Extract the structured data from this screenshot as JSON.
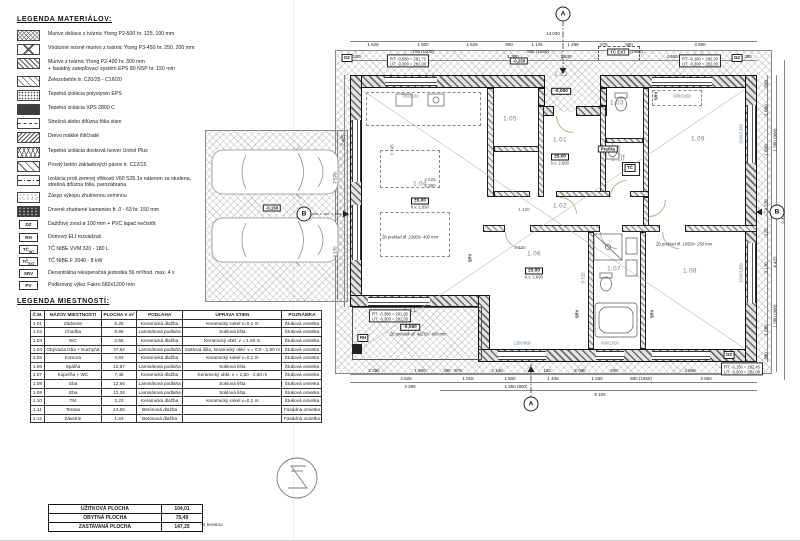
{
  "materials_legend": {
    "title": "LEGENDA MATERIÁLOV:",
    "items": [
      {
        "swatch": "hatch-cross",
        "text": "Murivo deliace z tvárnic Ytong P2-500 hr. 125, 100 mm"
      },
      {
        "swatch": "diag-cross",
        "text": "Vnútorné nosné murivo z tvárnic Ytong P3-450 hr. 250, 200 mm"
      },
      {
        "swatch": "hatch-diag",
        "text": "Murivo z tvárnic Ytong P2-400 hr. 300 mm\n+ fasádny zatepľovací systém EPS 80 NSP hr. 150 mm"
      },
      {
        "swatch": "diag-thin",
        "text": "Železobetón tr. C20/25 - C16/20"
      },
      {
        "swatch": "dots",
        "text": "Tepelná izolácia polystyrén EPS"
      },
      {
        "swatch": "solid-dark",
        "text": "Tepelná izolácia XPS 2800 C"
      },
      {
        "swatch": "dash-center",
        "text": "Strešná alebo difúzna fólia stien"
      },
      {
        "swatch": "back-diag",
        "text": "Drevo mäkké ihličnaté"
      },
      {
        "swatch": "zigzag",
        "text": "Tepelná izolácia dosková Isover Unirol Plus"
      },
      {
        "swatch": "diag-wide",
        "text": "Prostý betón základových pásov tr. C12/15"
      },
      {
        "swatch": "dashdot",
        "text": "Izolácia proti zemnej vlhkosti V60 S35 1x náterom za studena,\nstrešná difúzna fólia, parozábrana"
      },
      {
        "swatch": "stipple",
        "text": "Zásyp výkopu zhutnenou zeminou"
      },
      {
        "swatch": "gravel",
        "text": "Drvené zhutnené kamenivo fr. 0 - 63 hr. 150 mm"
      }
    ],
    "badges": [
      {
        "label": "DZ",
        "sub": "",
        "text": "Dažďový zvod ø 100 mm + PVC lapač nečistôt"
      },
      {
        "label": "RH",
        "sub": "",
        "text": "Domový ELI rozvádzač"
      },
      {
        "label": "TČ",
        "sub": "INT",
        "text": "TČ NIBE VVM 320 - 180 L"
      },
      {
        "label": "TČ",
        "sub": "EXT",
        "text": "TČ NIBE F 2040 - 8 kW"
      },
      {
        "label": "SRV",
        "sub": "",
        "text": "Decentrálna rekuperačná jednotka 56 m³/hod. max. 4 x"
      },
      {
        "label": "PV",
        "sub": "",
        "text": "Podkrovný výlez Fakro 660x1200 mm"
      }
    ]
  },
  "rooms_legend": {
    "title": "LEGENDA MIESTNOSTÍ:",
    "headers": [
      "Č.M.",
      "NÁZOV MIESTNOSTI",
      "PLOCHA V m²",
      "PODLAHA",
      "ÚPRAVA STIEN",
      "POZNÁMKA"
    ],
    "rows": [
      [
        "1.01",
        "Zádverie",
        "6,26",
        "Keramická dlažba",
        "Keramický sokel v=0,1 m",
        "Štuková omietka"
      ],
      [
        "1.02",
        "Chodba",
        "8,99",
        "Laminátová podlaha",
        "Soklová lišta",
        "Štuková omietka"
      ],
      [
        "1.03",
        "WC",
        "2,66",
        "Keramická dlažba",
        "Keramický obkl. v = 1,50 m",
        "Štuková omietka"
      ],
      [
        "1.04",
        "Obývacia izba + Kuchyňa",
        "37,62",
        "Laminátová podlaha",
        "Soklová lišta, keramický obkl. v = 0,9 - 1,50 m",
        "Štuková omietka"
      ],
      [
        "1.05",
        "Komora",
        "3,93",
        "Keramická dlažba",
        "Keramický sokel v=0,1 m",
        "Štuková omietka"
      ],
      [
        "1.06",
        "Spálňa",
        "12,87",
        "Laminátová podlaha",
        "Soklová lišta",
        "Štuková omietka"
      ],
      [
        "1.07",
        "Kúpeľňa + WC",
        "7,45",
        "Keramická dlažba",
        "Keramický obkl. v = 1,50 - 2,60 m",
        "Štuková omietka"
      ],
      [
        "1.08",
        "Izba",
        "12,66",
        "Laminátová podlaha",
        "Soklová lišta",
        "Štuková omietka"
      ],
      [
        "1.09",
        "Izba",
        "12,34",
        "Laminátová podlaha",
        "Soklová lišta",
        "Štuková omietka"
      ],
      [
        "1.10",
        "TM",
        "2,23",
        "Keramická dlažba",
        "Keramický sokel v=0,1 m",
        "Štuková omietka"
      ],
      [
        "1.11",
        "Terasa",
        "13,65",
        "Betónová dlažba",
        "",
        "Fasádna omietka"
      ],
      [
        "1.12",
        "Závetrie",
        "1,63",
        "Betónová dlažba",
        "",
        "Fasádna omietka"
      ]
    ],
    "summary": [
      [
        "ÚŽITKOVÁ PLOCHA",
        "104,01"
      ],
      [
        "OBYTNÁ PLOCHA",
        "75,49"
      ],
      [
        "ZASTAVANÁ PLOCHA",
        "147,25"
      ]
    ],
    "summary_note": "- s terasou"
  },
  "plan": {
    "rooms": [
      {
        "n": "1.04",
        "x": 420,
        "y": 196,
        "elev": "±0,00",
        "kv": "k.v. 2,690"
      },
      {
        "n": "1.05",
        "x": 510,
        "y": 120
      },
      {
        "n": "1.12",
        "x": 561,
        "y": 84,
        "elev": "-0,060"
      },
      {
        "n": "1.03",
        "x": 617,
        "y": 104
      },
      {
        "n": "1.10",
        "x": 618,
        "y": 160
      },
      {
        "n": "1.01",
        "x": 560,
        "y": 152,
        "elev": "±0,00",
        "kv": "k.v. 2,690"
      },
      {
        "n": "1.09",
        "x": 698,
        "y": 140
      },
      {
        "n": "1.02",
        "x": 560,
        "y": 207
      },
      {
        "n": "1.06",
        "x": 534,
        "y": 266,
        "elev": "±0,00",
        "kv": "k.v. 2,690"
      },
      {
        "n": "1.07",
        "x": 614,
        "y": 270
      },
      {
        "n": "1.08",
        "x": 690,
        "y": 272
      },
      {
        "n": "1.11",
        "x": 410,
        "y": 320,
        "elev": "-0,060"
      }
    ],
    "corner_notes": [
      {
        "x": 408,
        "y": 61,
        "l1": "RT: -0,580 = 281,72",
        "l2": "UT: -0,300 = 282,00"
      },
      {
        "x": 700,
        "y": 61,
        "l1": "RT: -0,180 = 282,20",
        "l2": "UT: -0,300 = 282,00"
      },
      {
        "x": 742,
        "y": 369,
        "l1": "RT: -0,150 = 282,45",
        "l2": "UT: -0,300 = 282,00"
      },
      {
        "x": 390,
        "y": 316,
        "l1": "RT: -0,380 = 281,95",
        "l2": "UT: -0,300 = 282,00"
      }
    ],
    "badges": [
      {
        "t": "DZ",
        "x": 347,
        "y": 58
      },
      {
        "t": "DZ",
        "x": 737,
        "y": 58
      },
      {
        "t": "DZ",
        "x": 729,
        "y": 355
      },
      {
        "t": "RH",
        "x": 363,
        "y": 338
      },
      {
        "t": "TČ",
        "x": 630,
        "y": 168
      }
    ],
    "labels": [
      {
        "t": "Pračka",
        "x": 608,
        "y": 149,
        "box": 1
      },
      {
        "t": "-0,150",
        "x": 272,
        "y": 208,
        "box": 1
      },
      {
        "t": "-0,250",
        "x": 519,
        "y": 61,
        "box": 1
      },
      {
        "t": "TČ EXT",
        "x": 618,
        "y": 52,
        "box": 1
      },
      {
        "t": "SRV",
        "x": 470,
        "y": 258,
        "rot": 1
      },
      {
        "t": "SRV",
        "x": 577,
        "y": 314,
        "rot": 1
      },
      {
        "t": "SRV",
        "x": 652,
        "y": 314,
        "rot": 1
      },
      {
        "t": "SRV",
        "x": 656,
        "y": 96,
        "rot": 1
      }
    ],
    "notes": [
      {
        "t": "Žb preklad dl. 2300/v. 400 mm",
        "x": 410,
        "y": 237
      },
      {
        "t": "Žb preklad dl. 1850/v. 250 mm",
        "x": 684,
        "y": 244
      },
      {
        "t": "Žb prievlak dl. 4625/v. 400 mm",
        "x": 418,
        "y": 334
      }
    ],
    "markers": [
      {
        "l": "A",
        "x": 563,
        "y": 14
      },
      {
        "l": "A",
        "x": 531,
        "y": 404
      },
      {
        "l": "B",
        "x": 304,
        "y": 214
      },
      {
        "l": "B",
        "x": 777,
        "y": 212
      }
    ],
    "dims": [
      {
        "t": "14 030",
        "x": 553,
        "y": 36
      },
      {
        "t": "1 625",
        "x": 373,
        "y": 47
      },
      {
        "t": "1 800",
        "x": 423,
        "y": 47
      },
      {
        "t": "1 625",
        "x": 472,
        "y": 47
      },
      {
        "t": "900",
        "x": 509,
        "y": 47
      },
      {
        "t": "1 125",
        "x": 537,
        "y": 47
      },
      {
        "t": "1 288",
        "x": 573,
        "y": 47
      },
      {
        "t": "875",
        "x": 604,
        "y": 47
      },
      {
        "t": "900",
        "x": 629,
        "y": 47
      },
      {
        "t": "3 800",
        "x": 700,
        "y": 47
      },
      {
        "t": "700 (1100)",
        "x": 423,
        "y": 53.5
      },
      {
        "t": "900 (1850)",
        "x": 538,
        "y": 53.5
      },
      {
        "t": "600 (1950)",
        "x": 632,
        "y": 53.5
      },
      {
        "t": "300",
        "x": 357,
        "y": 58.5
      },
      {
        "t": "4 625",
        "x": 423,
        "y": 58.5
      },
      {
        "t": "1 300",
        "x": 513,
        "y": 58.5
      },
      {
        "t": "1 630",
        "x": 566,
        "y": 58.5
      },
      {
        "t": "4 650",
        "x": 672,
        "y": 58.5
      },
      {
        "t": "300",
        "x": 748,
        "y": 58.5
      },
      {
        "t": "300",
        "x": 766,
        "y": 84,
        "r": 1
      },
      {
        "t": "1 680",
        "x": 766,
        "y": 110,
        "r": 1
      },
      {
        "t": "1 500",
        "x": 766,
        "y": 150,
        "r": 1
      },
      {
        "t": "4 320",
        "x": 766,
        "y": 205,
        "r": 1
      },
      {
        "t": "125",
        "x": 766,
        "y": 232,
        "r": 1
      },
      {
        "t": "3 170",
        "x": 766,
        "y": 268,
        "r": 1
      },
      {
        "t": "1 680",
        "x": 766,
        "y": 330,
        "r": 1
      },
      {
        "t": "300",
        "x": 766,
        "y": 356,
        "r": 1
      },
      {
        "t": "1 380 (900)",
        "x": 774.5,
        "y": 140,
        "r": 1
      },
      {
        "t": "4 425",
        "x": 774.5,
        "y": 262,
        "r": 1
      },
      {
        "t": "1 380 (900)",
        "x": 774.5,
        "y": 316,
        "r": 1
      },
      {
        "t": "9 470",
        "x": 783,
        "y": 218,
        "r": 1
      },
      {
        "t": "300",
        "x": 447,
        "y": 372.5
      },
      {
        "t": "3 136",
        "x": 497,
        "y": 372.5
      },
      {
        "t": "125",
        "x": 547,
        "y": 372.5
      },
      {
        "t": "2 030",
        "x": 580,
        "y": 372.5
      },
      {
        "t": "200",
        "x": 614,
        "y": 372.5
      },
      {
        "t": "3 856",
        "x": 690,
        "y": 372.5
      },
      {
        "t": "1 018",
        "x": 468,
        "y": 380.5
      },
      {
        "t": "1 500",
        "x": 510,
        "y": 380.5
      },
      {
        "t": "1 445",
        "x": 553,
        "y": 380.5
      },
      {
        "t": "1 260",
        "x": 597,
        "y": 380.5
      },
      {
        "t": "600 (1650)",
        "x": 641,
        "y": 380.5
      },
      {
        "t": "3 950",
        "x": 706,
        "y": 380.5
      },
      {
        "t": "1 350 (900)",
        "x": 516,
        "y": 388.5
      },
      {
        "t": "9 105",
        "x": 600,
        "y": 396.5
      },
      {
        "t": "2 390",
        "x": 374,
        "y": 372.5
      },
      {
        "t": "1 680",
        "x": 420,
        "y": 372.5
      },
      {
        "t": "975",
        "x": 458,
        "y": 372.5
      },
      {
        "t": "4 625",
        "x": 406,
        "y": 380.5
      },
      {
        "t": "3 290",
        "x": 410,
        "y": 388.5
      },
      {
        "t": "7 570",
        "x": 335,
        "y": 178,
        "r": 1
      },
      {
        "t": "4 175",
        "x": 335,
        "y": 252,
        "r": 1
      },
      {
        "t": "2 425",
        "x": 343,
        "y": 140,
        "r": 1
      },
      {
        "t": "4 625",
        "x": 430,
        "y": 182,
        "i": 1
      },
      {
        "t": "2 390",
        "x": 430,
        "y": 188,
        "i": 1
      },
      {
        "t": "1 420",
        "x": 524,
        "y": 212,
        "i": 1
      },
      {
        "t": "2 530",
        "x": 520,
        "y": 250,
        "i": 1
      },
      {
        "t": "3 745",
        "x": 392,
        "y": 150,
        "r": 1,
        "i": 1
      },
      {
        "t": "3 725",
        "x": 583,
        "y": 278,
        "r": 1,
        "i": 1
      }
    ],
    "window_tags": [
      {
        "t": "700/1100",
        "x": 410,
        "y": 96
      },
      {
        "t": "600/1950",
        "x": 682,
        "y": 96
      },
      {
        "t": "1350/900",
        "x": 522,
        "y": 343
      },
      {
        "t": "600/1650",
        "x": 610,
        "y": 343
      },
      {
        "t": "1500/1380",
        "x": 741,
        "y": 134,
        "r": 1
      },
      {
        "t": "1500/1380",
        "x": 741,
        "y": 273,
        "r": 1
      }
    ]
  },
  "colors": {
    "door_arc": "#c8b078",
    "window_tag": "#5b84a8",
    "wall_hatch": "#6a6a6a",
    "plot_hatch": "#8a8a8a"
  }
}
